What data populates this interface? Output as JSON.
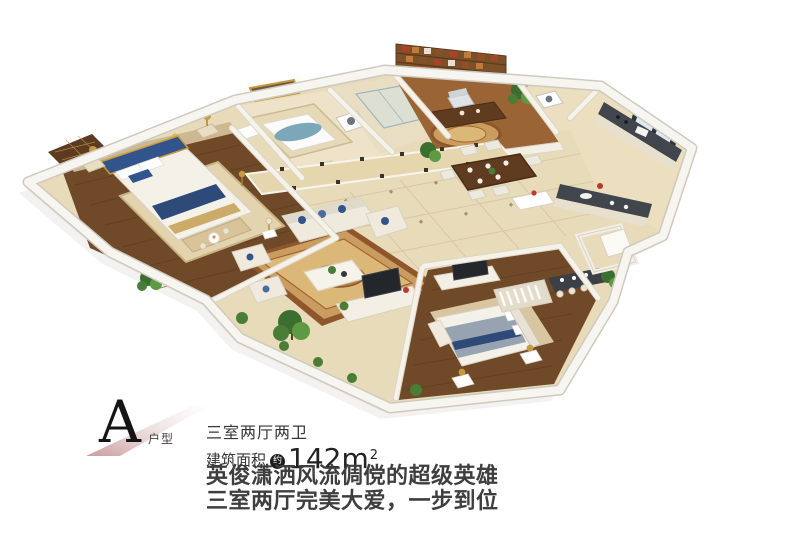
{
  "plate": {
    "letter": "A",
    "letter_label": "户型"
  },
  "specs": {
    "layout": "三室两厅两卫",
    "area_prefix": "建筑面积",
    "area_approx_badge": "约",
    "area_value": "142m",
    "area_sup": "2"
  },
  "slogan": {
    "line1": "英俊潇洒风流倜傥的超级英雄",
    "line2": "三室两厅完美大爱，一步到位"
  },
  "palette": {
    "wall_white": "#f7f5f0",
    "marble_floor": "#e8dbba",
    "dark_wood": "#6f4928",
    "rug_gold": "#c99d5f",
    "accent_blue": "#31548c",
    "accent_gold": "#c69a3f",
    "counter_dark": "#41464d",
    "plant_green": "#4a7d36",
    "plate_rose": "#c89b9b",
    "text_dark": "#3e3e3e"
  }
}
